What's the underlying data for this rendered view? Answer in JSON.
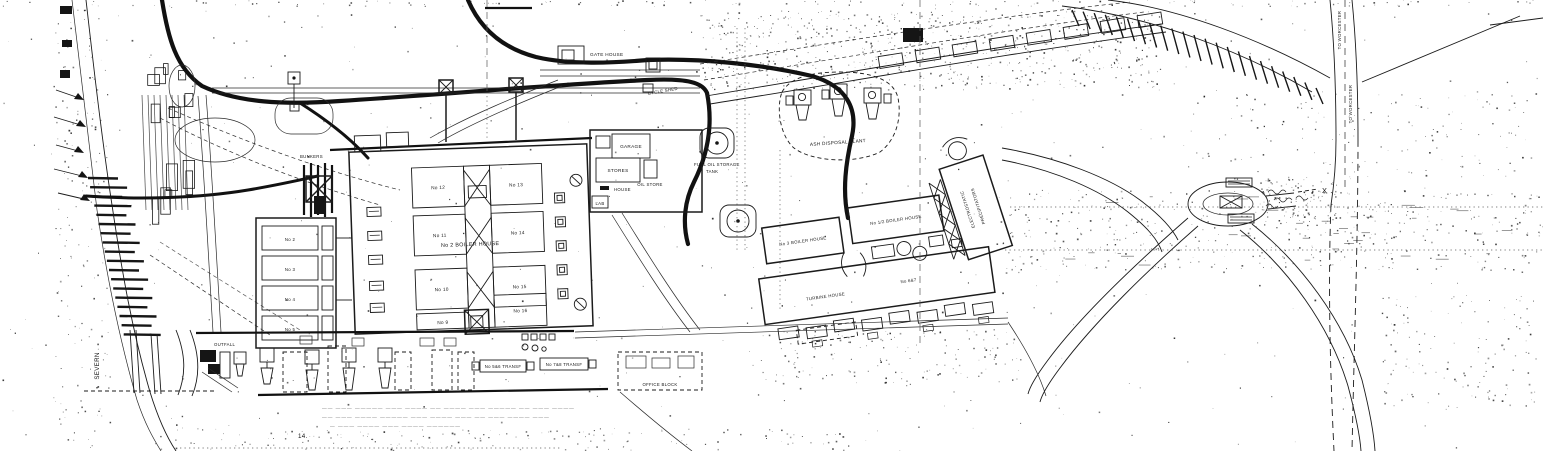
{
  "river": {
    "label": "SEVERN"
  },
  "labels": {
    "gate_house": "GATE HOUSE",
    "cycle_shed": "CYCLE SHED",
    "garage": "GARAGE",
    "stores": "STORES",
    "oil_store": "OIL STORE",
    "lab": "LAB",
    "weigh_house": "HOUSE",
    "bunkers": "BUNKERS",
    "boiler_house_no2": "No 2 BOILER HOUSE",
    "ash_plant": "ASH DISPOSAL PLANT",
    "fuel_tank_line1": "FUEL OIL STORAGE",
    "fuel_tank_line2": "TANK",
    "precip_line1": "ELECTROSTATIC",
    "precip_line2": "PRECIPITATORS",
    "boiler_house_no3": "No 3 BOILER HOUSE",
    "boiler_house_no12": "No 1/2 BOILER HOUSE",
    "turbine_house": "TURBINE HOUSE",
    "trans_56": "No 5&6 TRANSF",
    "trans_78": "No 7&8 TRANSF",
    "trans_67": "No 6&7",
    "office_block": "OFFICE BLOCK",
    "outfall": "OUTFALL",
    "to_worcester_top": "TO WORCESTER",
    "to_worcester_bottom": "TO WORCESTER",
    "x_marker": "X",
    "figure_number": "14."
  },
  "units": [
    "No 12",
    "No 13",
    "No 11",
    "No 14",
    "No 10",
    "No 15",
    "No 9",
    "No 16"
  ],
  "bays": [
    "No 2",
    "No 3",
    "No 4",
    "No 5"
  ],
  "notes": {
    "line1": "—— ——— ————— ——— ———— —— ———— ——— ————— —— ——— ————",
    "line2": "—— ——— ———— ————— ——— ———— ——— —— ——— ———— ———",
    "line3": "— ——— ———— ——— ———— ——————"
  },
  "colors": {
    "ink": "#1b1b1b",
    "paper": "#ffffff",
    "faint": "#5a5a5a"
  }
}
